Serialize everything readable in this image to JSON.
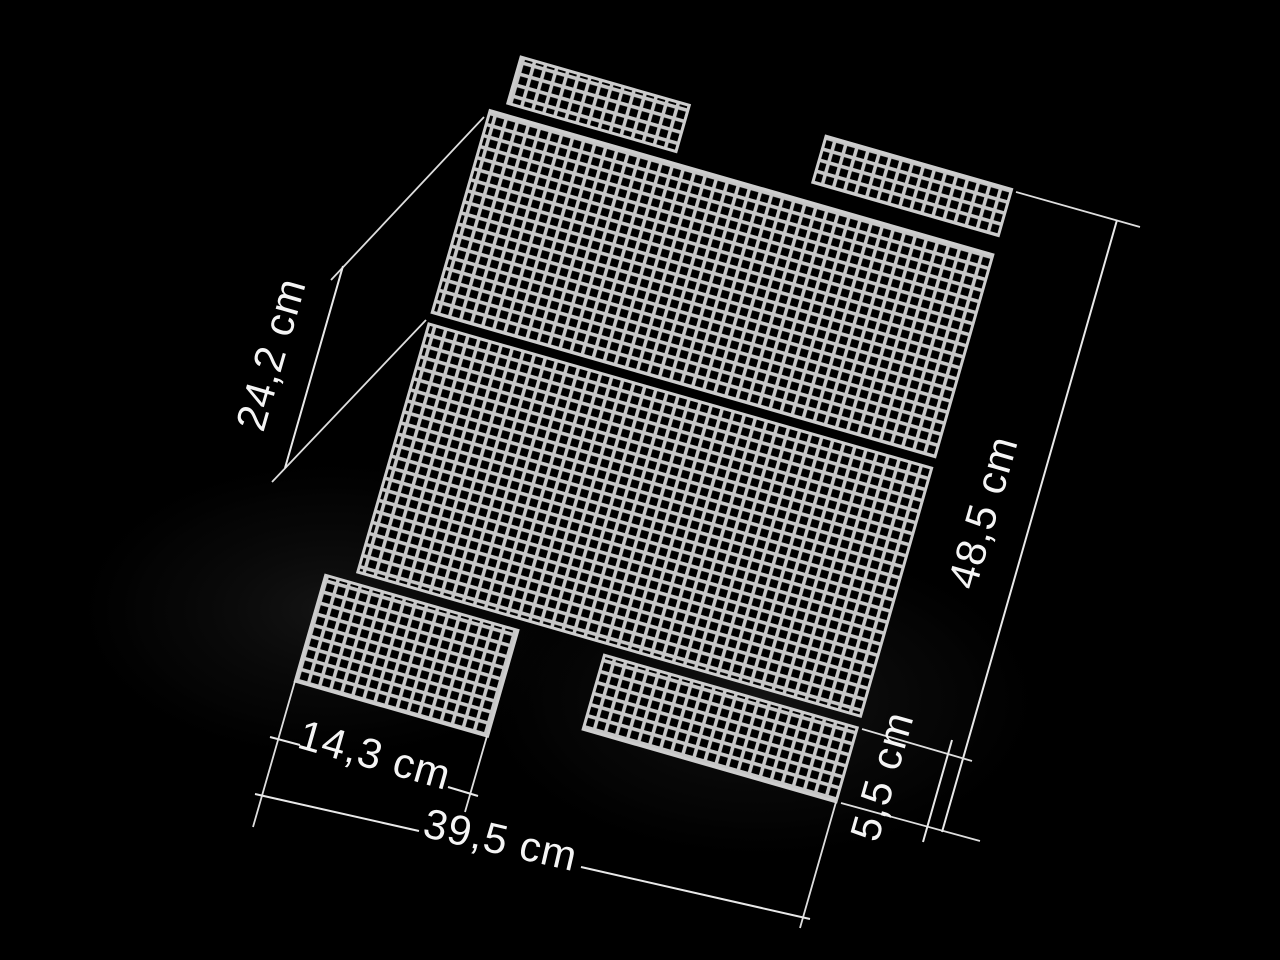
{
  "image": {
    "type": "product-photo",
    "subject": "Set of plastic canvas mesh panels for bag making, laid out on a black background with measurement annotations",
    "background_color": "#000000",
    "mesh_color": "#c6c6c6",
    "mesh_hole_color": "#000000",
    "annotation_line_color": "#e9e9e9",
    "annotation_text_color": "#f5f5f5"
  },
  "measurements": {
    "upper_left_edge": "24,2 cm",
    "right_side_total": "48,5 cm",
    "bottom_left_piece_width": "14,3 cm",
    "bottom_total_width": "39,5 cm",
    "bottom_right_piece_height": "5,5 cm"
  }
}
